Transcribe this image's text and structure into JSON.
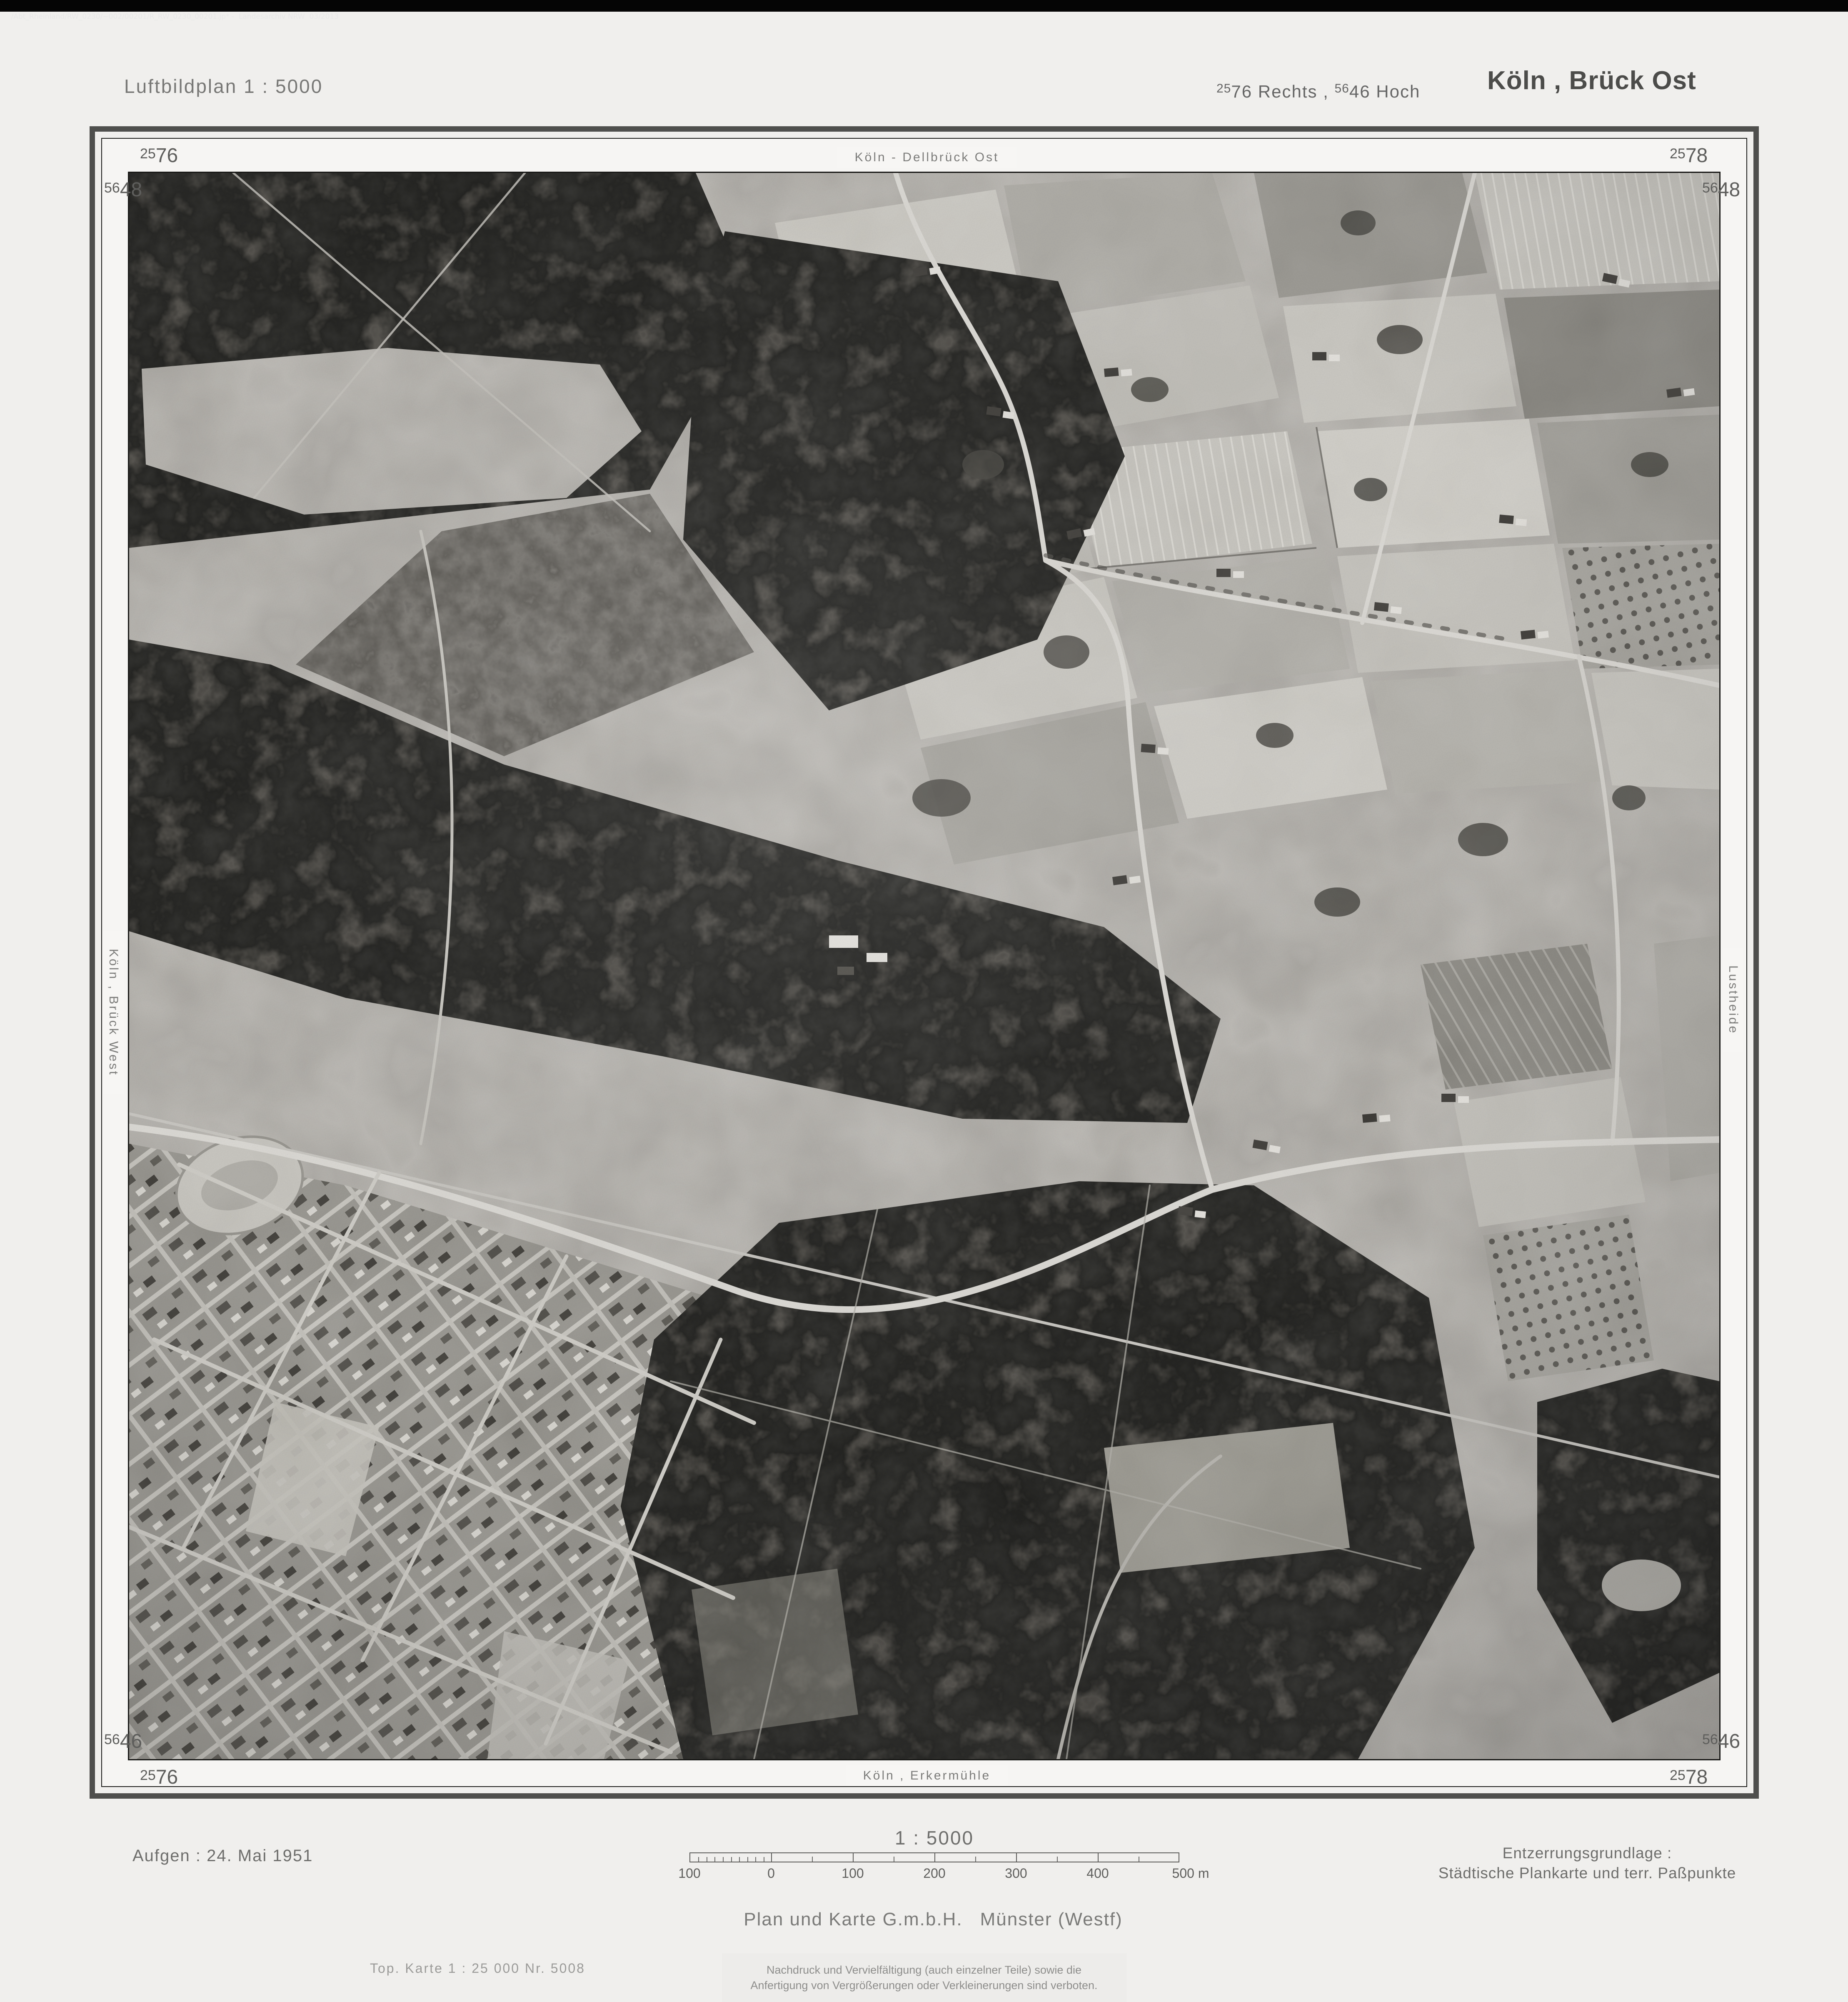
{
  "viewer": {
    "titlebar_text": "/Abt_Rheinland/RW_0230/~002/00201/R_RW_0230_00201.jp* -  Landesarchiv NRW  03/2013"
  },
  "header": {
    "plan_type": "Luftbildplan 1 : 5000",
    "grid_ref": {
      "rechts_sup": "25",
      "rechts_num": "76",
      "rechts_word": "Rechts ,",
      "hoch_sup": "56",
      "hoch_num": "46",
      "hoch_word": "Hoch"
    },
    "sheet_title": "Köln , Brück Ost"
  },
  "frame": {
    "corner_labels": {
      "top_left_e": {
        "sup": "25",
        "num": "76"
      },
      "top_left_n": {
        "sup": "56",
        "num": "48"
      },
      "top_right_e": {
        "sup": "25",
        "num": "78"
      },
      "top_right_n": {
        "sup": "56",
        "num": "48"
      },
      "bottom_left_n": {
        "sup": "56",
        "num": "46"
      },
      "bottom_left_e": {
        "sup": "25",
        "num": "76"
      },
      "bottom_right_n": {
        "sup": "56",
        "num": "46"
      },
      "bottom_right_e": {
        "sup": "25",
        "num": "78"
      }
    },
    "edge_labels": {
      "top": "Köln - Dellbrück Ost",
      "left": "Köln , Brück West",
      "right": "Lustheide",
      "bottom": "Köln , Erkermühle"
    }
  },
  "footer": {
    "date": "Aufgen :  24. Mai 1951",
    "scale": {
      "title": "1 : 5000",
      "tick_labels": [
        "100",
        "0",
        "100",
        "200",
        "300",
        "400"
      ],
      "unit_label": "500 m"
    },
    "rectification": {
      "line1": "Entzerrungsgrundlage :",
      "line2": "Städtische Plankarte und terr. Paßpunkte"
    },
    "publisher_1": "Plan und Karte G.m.b.H.",
    "publisher_2": "Münster (Westf)",
    "map_ref": "Top. Karte 1 : 25 000  Nr. 5008",
    "copyright": {
      "line1": "Nachdruck und Vervielfältigung (auch einzelner Teile) sowie die",
      "line2": "Anfertigung von Vergrößerungen oder Verkleinerungen sind verboten."
    }
  },
  "colors": {
    "paper": "#f6f5f3",
    "frame_line": "#1c1c1a",
    "titlebar_bg": "#050505",
    "photo_mid_gray": "#b4b2ac",
    "forest_dark": "#2e2c28"
  }
}
